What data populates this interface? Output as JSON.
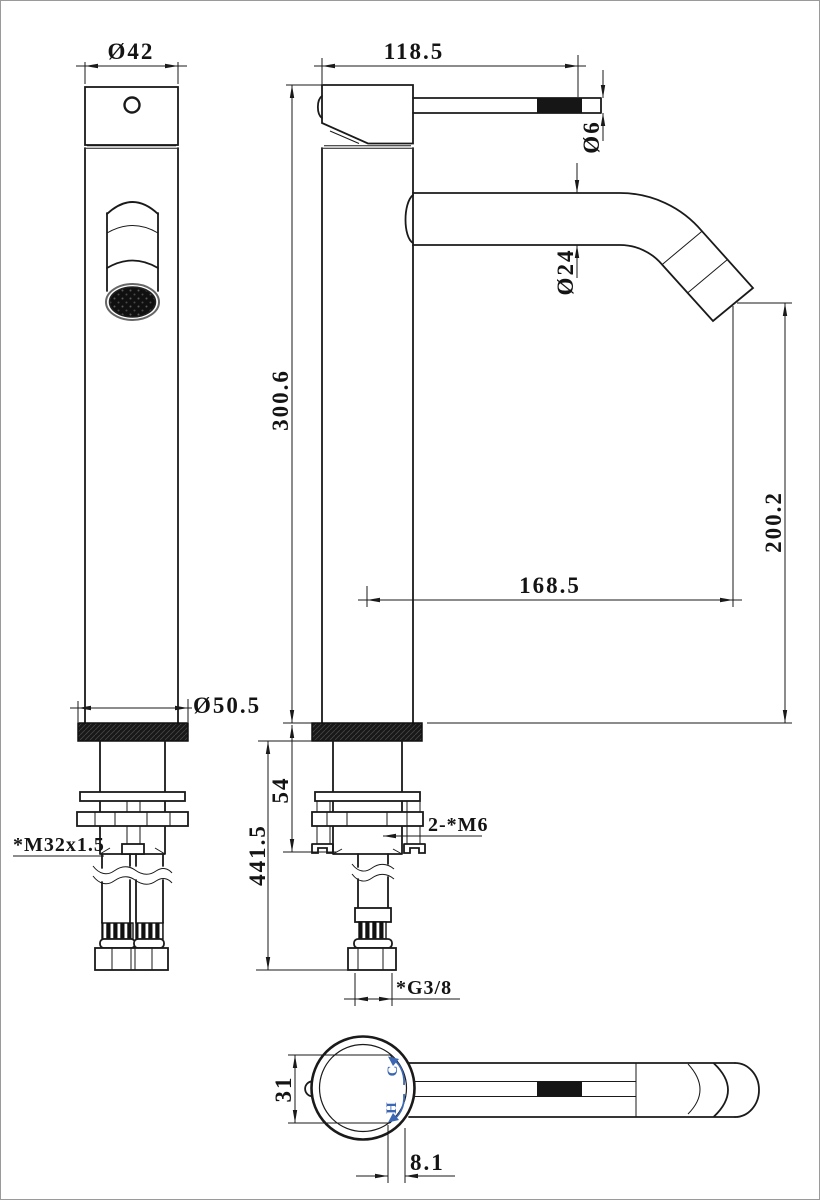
{
  "drawing": {
    "colors": {
      "line": "#1a1a1a",
      "accent_blue": "#3b67b3",
      "background": "#ffffff"
    },
    "front_view": {
      "top_diameter": "Ø42",
      "base_diameter": "Ø50.5",
      "base_thread": "*M32x1.5"
    },
    "side_view": {
      "handle_length": "118.5",
      "handle_rod_diameter": "Ø6",
      "spout_diameter": "Ø24",
      "body_height": "300.6",
      "spout_outlet_height": "200.2",
      "spout_reach": "168.5",
      "deck_section": "54",
      "total_height": "441.5",
      "fixing_studs": "2-*M6",
      "inlet_thread": "*G3/8"
    },
    "top_view": {
      "handle_base_width": "31",
      "outlet_offset": "8.1",
      "cold_indicator": "C",
      "hot_indicator": "H"
    }
  }
}
